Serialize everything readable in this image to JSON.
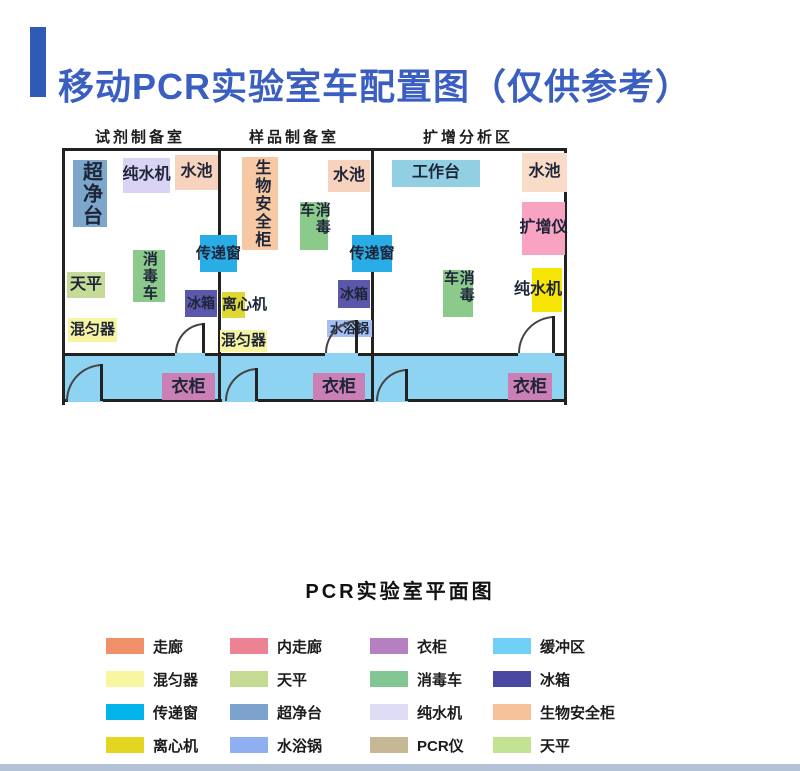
{
  "title": {
    "text": "移动PCR实验室车配置图（仅供参考）",
    "text_color": "#3a5fc0",
    "bar_color": "#2f5bb7"
  },
  "plan": {
    "wall_color": "#222222",
    "corridor_color": "#8ed3f2",
    "room_labels": [
      {
        "id": "reagent-prep-room",
        "text": "试剂制备室",
        "cx": 140
      },
      {
        "id": "sample-prep-room",
        "text": "样品制备室",
        "cx": 294
      },
      {
        "id": "amplification-area",
        "text": "扩增分析区",
        "cx": 468
      }
    ],
    "dividers": [
      {
        "x": 153
      },
      {
        "x": 306
      }
    ],
    "corridor_top_wall": [
      {
        "x": 0,
        "w": 110
      },
      {
        "x": 140,
        "w": 120
      },
      {
        "x": 293,
        "w": 160
      },
      {
        "x": 490,
        "w": 9
      }
    ],
    "bottom_wall": [
      {
        "x": 0,
        "w": 3
      },
      {
        "x": 38,
        "w": 119
      },
      {
        "x": 193,
        "w": 115
      },
      {
        "x": 343,
        "w": 156
      }
    ],
    "equipment": [
      {
        "id": "clean-bench",
        "label": "超净台",
        "x": 8,
        "y": 9,
        "w": 34,
        "h": 67,
        "bg": "#7da6cb",
        "fs": 20,
        "vert": true
      },
      {
        "id": "water-purifier",
        "label": "纯水机",
        "x": 58,
        "y": 7,
        "w": 47,
        "h": 35,
        "bg": "#dad4f4",
        "fs": 16
      },
      {
        "id": "sink",
        "label": "水池",
        "x": 110,
        "y": 4,
        "w": 43,
        "h": 35,
        "bg": "#f7d2bd",
        "fs": 16
      },
      {
        "id": "balance",
        "label": "天平",
        "x": 2,
        "y": 121,
        "w": 38,
        "h": 26,
        "bg": "#c6db97",
        "fs": 16
      },
      {
        "id": "disinfection-cart",
        "label": "消毒车",
        "x": 68,
        "y": 99,
        "w": 32,
        "h": 52,
        "bg": "#8cca8c",
        "fs": 15,
        "vert": true
      },
      {
        "id": "mixer",
        "label": "混匀器",
        "x": 3,
        "y": 167,
        "w": 49,
        "h": 24,
        "bg": "#f8f5a2",
        "fs": 15
      },
      {
        "id": "fridge",
        "label": "冰箱",
        "x": 120,
        "y": 139,
        "w": 32,
        "h": 27,
        "bg": "#5b57aa",
        "fs": 14
      },
      {
        "id": "transfer-window",
        "label": "传递窗",
        "x": 135,
        "y": 84,
        "w": 37,
        "h": 37,
        "bg": "#29ade6",
        "fs": 15
      },
      {
        "id": "biosafety-cabinet",
        "label": "生物安全柜",
        "x": 177,
        "y": 6,
        "w": 36,
        "h": 93,
        "bg": "#f6c9a4",
        "fs": 16,
        "vert": true
      },
      {
        "id": "sink",
        "label": "水池",
        "x": 263,
        "y": 9,
        "w": 42,
        "h": 32,
        "bg": "#f7d2bd",
        "fs": 16
      },
      {
        "id": "disinfection-cart",
        "label": "消毒车",
        "x": 235,
        "y": 51,
        "w": 28,
        "h": 48,
        "bg": "#8cca8c",
        "fs": 15,
        "vert": true
      },
      {
        "id": "centrifuge",
        "label": "离心机",
        "x": 157,
        "y": 141,
        "w": 23,
        "h": 26,
        "bg": "#e0d832",
        "fs": 15,
        "anchor": "left"
      },
      {
        "id": "mixer",
        "label": "混匀器",
        "x": 155,
        "y": 179,
        "w": 47,
        "h": 22,
        "bg": "#f8f5a2",
        "fs": 15
      },
      {
        "id": "fridge",
        "label": "冰箱",
        "x": 273,
        "y": 129,
        "w": 32,
        "h": 28,
        "bg": "#5b57aa",
        "fs": 14
      },
      {
        "id": "water-bath",
        "label": "水浴锅",
        "x": 262,
        "y": 169,
        "w": 45,
        "h": 17,
        "bg": "#a5c0f0",
        "fs": 13
      },
      {
        "id": "transfer-window",
        "label": "传递窗",
        "x": 287,
        "y": 84,
        "w": 40,
        "h": 37,
        "bg": "#29ade6",
        "fs": 15
      },
      {
        "id": "workbench",
        "label": "工作台",
        "x": 327,
        "y": 9,
        "w": 88,
        "h": 27,
        "bg": "#92cfe2",
        "fs": 16
      },
      {
        "id": "sink",
        "label": "水池",
        "x": 457,
        "y": 2,
        "w": 45,
        "h": 39,
        "bg": "#f8dcc8",
        "fs": 16
      },
      {
        "id": "pcr-amplifier",
        "label": "扩增仪",
        "x": 457,
        "y": 51,
        "w": 43,
        "h": 53,
        "bg": "#f8a3c2",
        "fs": 16
      },
      {
        "id": "water-purifier",
        "label": "纯水机",
        "x": 467,
        "y": 117,
        "w": 30,
        "h": 44,
        "bg": "#f6e505",
        "fs": 16,
        "anchor": "right"
      },
      {
        "id": "disinfection-cart",
        "label": "消毒车",
        "x": 378,
        "y": 119,
        "w": 30,
        "h": 47,
        "bg": "#8cca8c",
        "fs": 15,
        "vert": true
      },
      {
        "id": "wardrobe",
        "label": "衣柜",
        "x": 97,
        "y": 222,
        "w": 53,
        "h": 27,
        "bg": "#cb80b5",
        "fs": 17
      },
      {
        "id": "wardrobe",
        "label": "衣柜",
        "x": 248,
        "y": 222,
        "w": 52,
        "h": 27,
        "bg": "#cb80b5",
        "fs": 17
      },
      {
        "id": "wardrobe",
        "label": "衣柜",
        "x": 443,
        "y": 222,
        "w": 44,
        "h": 27,
        "bg": "#cb80b5",
        "fs": 17
      }
    ],
    "doors": [
      {
        "id": "room1-door",
        "x": 110,
        "y": 172,
        "r": 30
      },
      {
        "id": "room2-door",
        "x": 260,
        "y": 169,
        "r": 33
      },
      {
        "id": "room3-door",
        "x": 453,
        "y": 165,
        "r": 37
      },
      {
        "id": "corridor1-door",
        "x": 1,
        "y": 213,
        "r": 37
      },
      {
        "id": "corridor2-door",
        "x": 160,
        "y": 217,
        "r": 33
      },
      {
        "id": "corridor3-door",
        "x": 311,
        "y": 218,
        "r": 32
      }
    ]
  },
  "legend": {
    "title": "PCR实验室平面图",
    "items": [
      {
        "label": "走廊",
        "color": "#f0906a"
      },
      {
        "label": "内走廊",
        "color": "#ed8292"
      },
      {
        "label": "衣柜",
        "color": "#b57fc2"
      },
      {
        "label": "缓冲区",
        "color": "#6fd1f5"
      },
      {
        "label": "混匀器",
        "color": "#f8f6a0"
      },
      {
        "label": "天平",
        "color": "#c5db94"
      },
      {
        "label": "消毒车",
        "color": "#82c694"
      },
      {
        "label": "冰箱",
        "color": "#4a48a2"
      },
      {
        "label": "传递窗",
        "color": "#00b4ea"
      },
      {
        "label": "超净台",
        "color": "#7ba3cd"
      },
      {
        "label": "纯水机",
        "color": "#dfdcf6"
      },
      {
        "label": "生物安全柜",
        "color": "#f7c19a"
      },
      {
        "label": "离心机",
        "color": "#e3d620"
      },
      {
        "label": "水浴锅",
        "color": "#90aff0"
      },
      {
        "label": "PCR仪",
        "color": "#c6b795"
      },
      {
        "label": "天平",
        "color": "#c3e392"
      }
    ]
  },
  "bottom_strip_color": "#b3c2d6"
}
